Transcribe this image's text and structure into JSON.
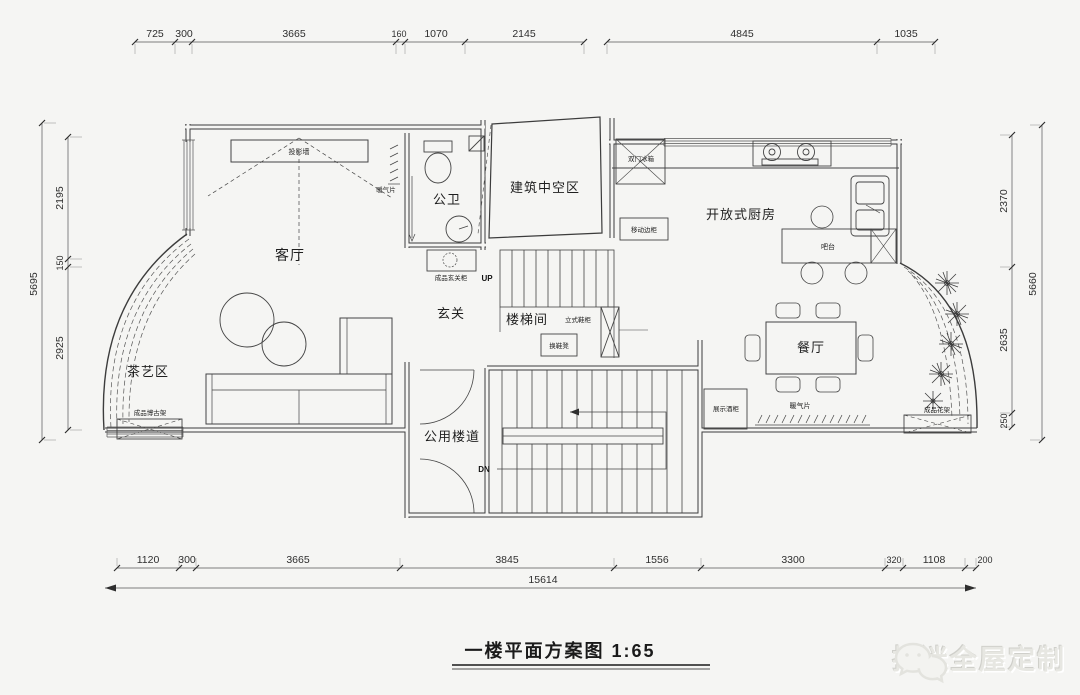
{
  "title": "一楼平面方案图 1:65",
  "watermark": "拉迷全屋定制",
  "dims": {
    "top": [
      "725",
      "300",
      "3665",
      "160",
      "1070",
      "2145",
      "4845",
      "1035"
    ],
    "bottom": [
      "1120",
      "300",
      "3665",
      "3845",
      "1556",
      "3300",
      "320",
      "1108",
      "200"
    ],
    "bottom_total": "15614",
    "left_total": "5695",
    "left": [
      "2195",
      "150",
      "2925"
    ],
    "right_total": "5660",
    "right": [
      "2370",
      "2635",
      "250"
    ]
  },
  "rooms": {
    "living": "客厅",
    "tea": "茶艺区",
    "bath": "公卫",
    "foyer": "玄关",
    "stairwell": "楼梯间",
    "void": "建筑中空区",
    "kitchen": "开放式厨房",
    "dining": "餐厅",
    "corridor": "公用楼道"
  },
  "ann": {
    "projection_wall": "投影墙",
    "radiator_bath": "暖气片",
    "radiator_dining": "暖气片",
    "entry_cabinet": "成品玄关柜",
    "curio_shelf": "成品博古架",
    "fridge": "双门冰箱",
    "mobile_cabinet": "移动边柜",
    "bar_counter": "吧台",
    "shoe_cabinet": "立式鞋柜",
    "shoe_bench": "换鞋凳",
    "wine_cabinet": "展示酒柜",
    "flower_stand": "成品花架",
    "up": "UP",
    "dn": "DN"
  }
}
